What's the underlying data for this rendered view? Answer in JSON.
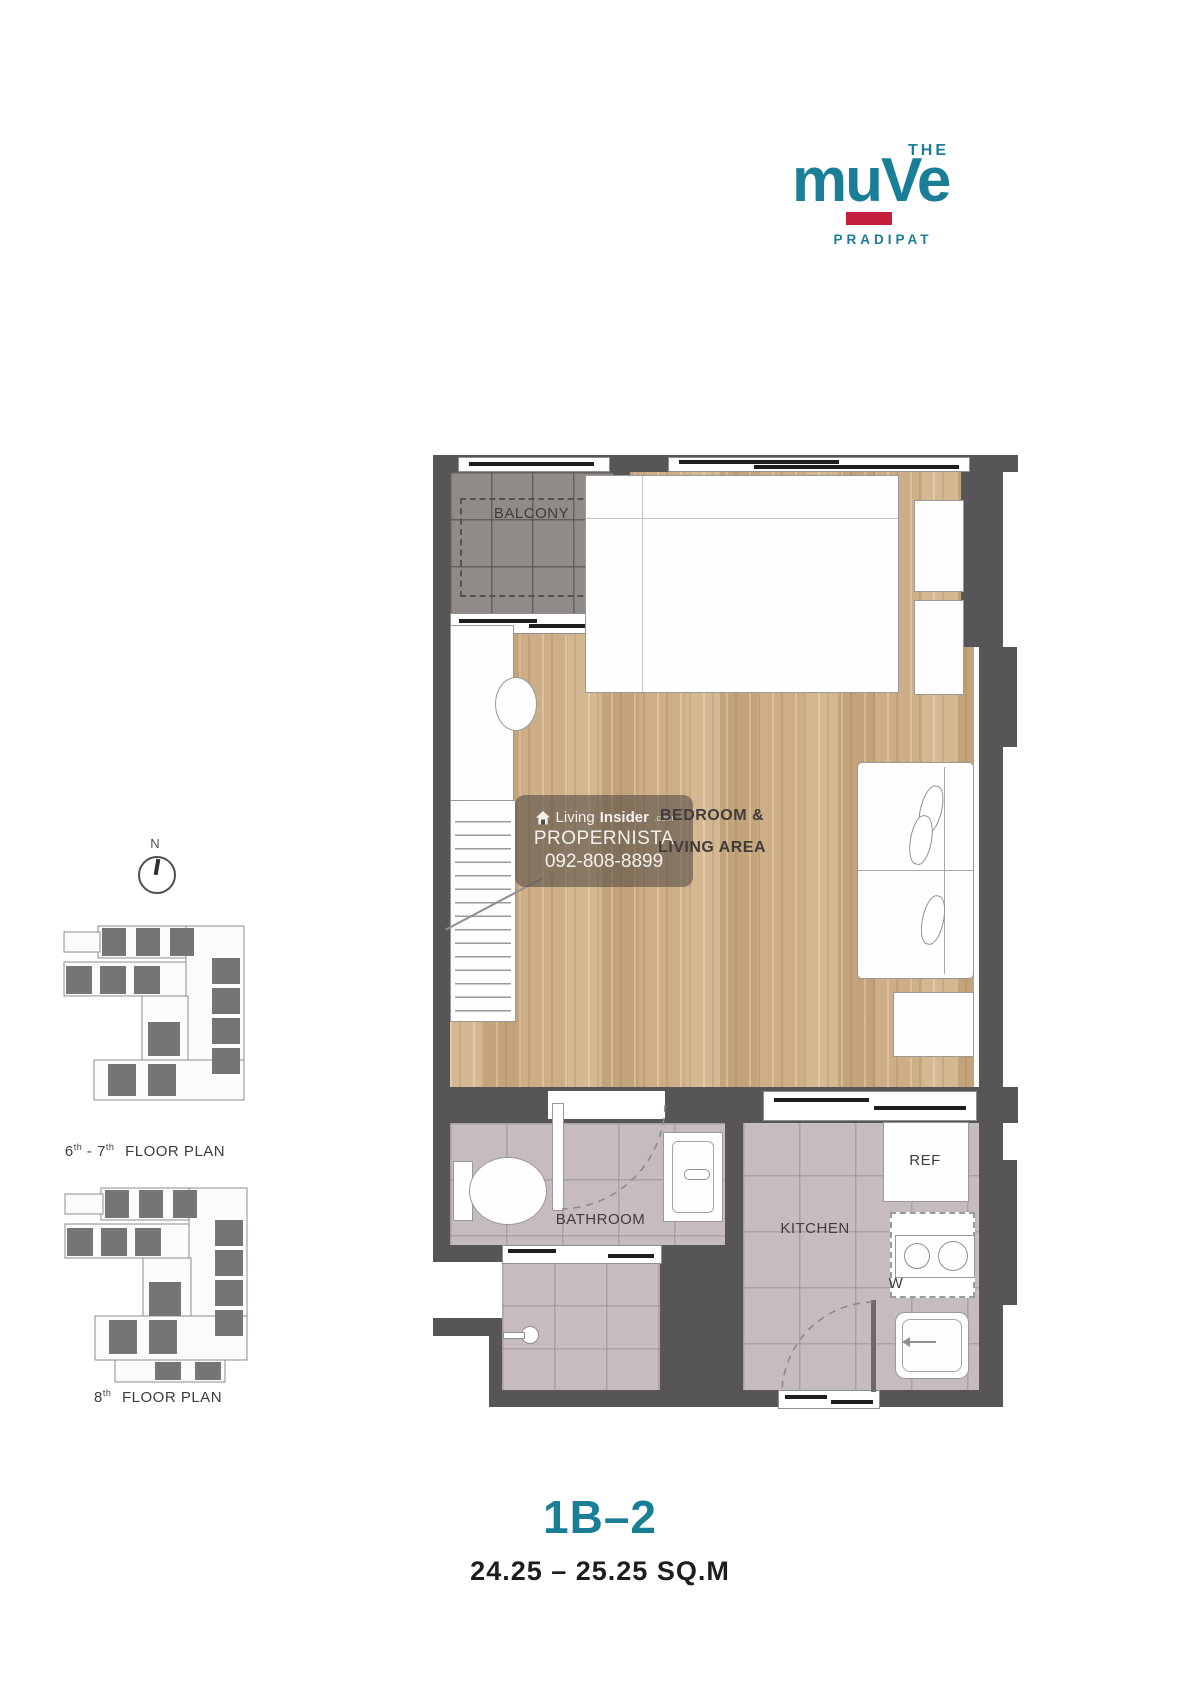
{
  "page": {
    "width": 1200,
    "height": 1687
  },
  "logo": {
    "the": "THE",
    "name": "muVe",
    "subtitle": "PRADIPAT",
    "teal": "#1b7e97",
    "red": "#c4203d"
  },
  "compass": {
    "north_label": "N"
  },
  "side_plans": {
    "plan_6_7": {
      "floor_1": "6",
      "sup_1": "th",
      "separator": "-",
      "floor_2": "7",
      "sup_2": "th",
      "suffix": "FLOOR PLAN"
    },
    "plan_8": {
      "floor_1": "8",
      "sup_1": "th",
      "suffix": "FLOOR PLAN"
    }
  },
  "watermark": {
    "brand_a": "Living",
    "brand_b": "Insider",
    "brand_tld": ".com",
    "line_2": "PROPERNISTA",
    "phone": "092-808-8899"
  },
  "floor_plan": {
    "rooms": {
      "balcony": "BALCONY",
      "bedroom_line_1": "BEDROOM &",
      "bedroom_line_2": "LIVING AREA",
      "bathroom": "BATHROOM",
      "kitchen": "KITCHEN"
    },
    "appliances": {
      "refrigerator": "REF",
      "washer": "W"
    },
    "colors": {
      "wall": "#585558",
      "wood": "#c9aa81",
      "tile": "#c6bcbe",
      "balcony_floor": "#908b89"
    }
  },
  "unit": {
    "code": "1B–2",
    "area_range": "24.25 – 25.25 SQ.M"
  }
}
